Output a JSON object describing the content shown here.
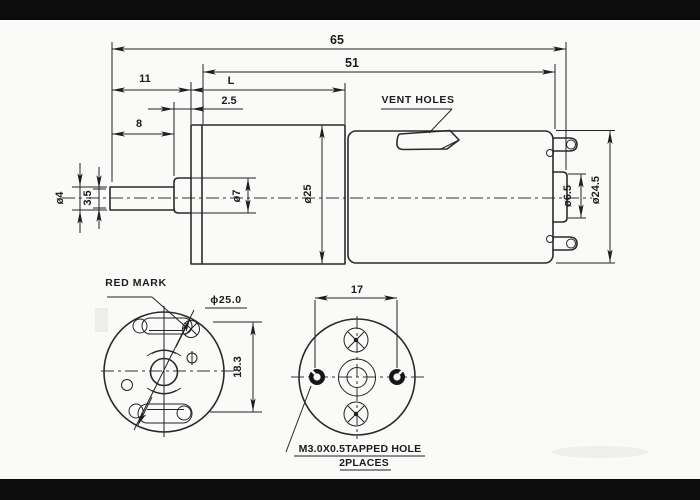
{
  "colors": {
    "background": "#fafaf9",
    "line": "#2a2a2a",
    "letterbox_bar": "#0c0c0c"
  },
  "side_view": {
    "dim_overall_length": "65",
    "dim_body_length": "51",
    "dim_shaft_to_face": "11",
    "dim_gearbox_length": "L",
    "dim_hub_protrusion": "2.5",
    "dim_shaft_exposed": "8",
    "dim_shaft_diameter": "ø4",
    "dim_shaft_flat": "3.5",
    "dim_hub_diameter": "ø7",
    "dim_gearbox_diameter": "ø25",
    "dim_rear_boss_diameter": "ø6.5",
    "dim_motor_diameter": "ø24.5",
    "vent_holes_label": "VENT HOLES"
  },
  "front_view": {
    "red_mark_label": "RED MARK",
    "dim_face_diameter": "ϕ25.0",
    "dim_slot_spacing": "18.3"
  },
  "rear_view": {
    "dim_tapped_hole_spacing": "17",
    "note_line1": "M3.0X0.5TAPPED HOLE",
    "note_line2": "2PLACES"
  }
}
